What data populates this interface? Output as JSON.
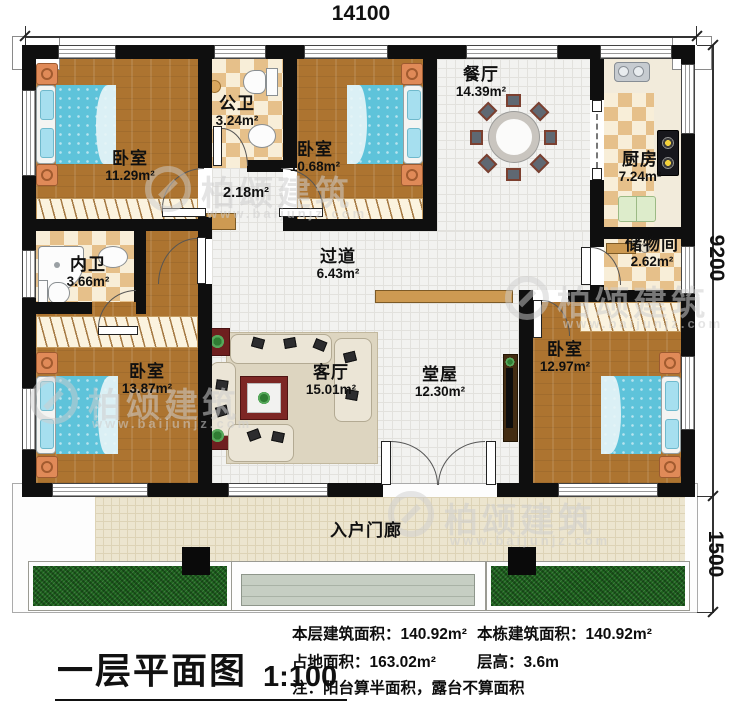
{
  "plan": {
    "type": "floor-plan",
    "floor": "first"
  },
  "dimensions": {
    "width_total": "14100",
    "depth_main": "9200",
    "depth_porch": "1500"
  },
  "rooms": [
    {
      "id": "bedroom-1",
      "name": "卧室",
      "area": "11.29m²"
    },
    {
      "id": "public-bathroom",
      "name": "公卫",
      "area": "3.24m²"
    },
    {
      "id": "corridor",
      "name": "",
      "area": "2.18m²"
    },
    {
      "id": "bedroom-2",
      "name": "卧室",
      "area": "10.68m²"
    },
    {
      "id": "dining-room",
      "name": "餐厅",
      "area": "14.39m²"
    },
    {
      "id": "kitchen",
      "name": "厨房",
      "area": "7.24m²"
    },
    {
      "id": "storage-room",
      "name": "储物间",
      "area": "2.62m²"
    },
    {
      "id": "ensuite-bathroom",
      "name": "内卫",
      "area": "3.66m²"
    },
    {
      "id": "hallway",
      "name": "过道",
      "area": "6.43m²"
    },
    {
      "id": "bedroom-3",
      "name": "卧室",
      "area": "13.87m²"
    },
    {
      "id": "living-room",
      "name": "客厅",
      "area": "15.01m²"
    },
    {
      "id": "main-hall",
      "name": "堂屋",
      "area": "12.30m²"
    },
    {
      "id": "bedroom-4",
      "name": "卧室",
      "area": "12.97m²"
    },
    {
      "id": "entry-porch",
      "name": "入户门廊",
      "area": ""
    }
  ],
  "title_block": {
    "title": "一层平面图",
    "scale": "1:100"
  },
  "stats": {
    "col1": [
      {
        "label": "本层建筑面积：",
        "value": "140.92m²"
      },
      {
        "label": "占地面积：",
        "value": "163.02m²"
      }
    ],
    "col2": [
      {
        "label": "本栋建筑面积：",
        "value": "140.92m²"
      },
      {
        "label": "层高：",
        "value": "3.6m"
      }
    ],
    "note": "注：阳台算半面积，露台不算面积"
  },
  "watermark": {
    "brand": "柏颂建筑",
    "url": "www.baijunjz.com"
  },
  "colors": {
    "wall": "#0f0f0f",
    "wood_floor": "#ad7430",
    "tile_dark": "#e6c08a",
    "tile_light": "#f8eed8",
    "white_tile": "#f2f2f0",
    "porch_tile": "#ece5cf",
    "bed_blue": "#5ec3da",
    "grass_green": "#1d641d",
    "accent_red": "#7d2724"
  }
}
